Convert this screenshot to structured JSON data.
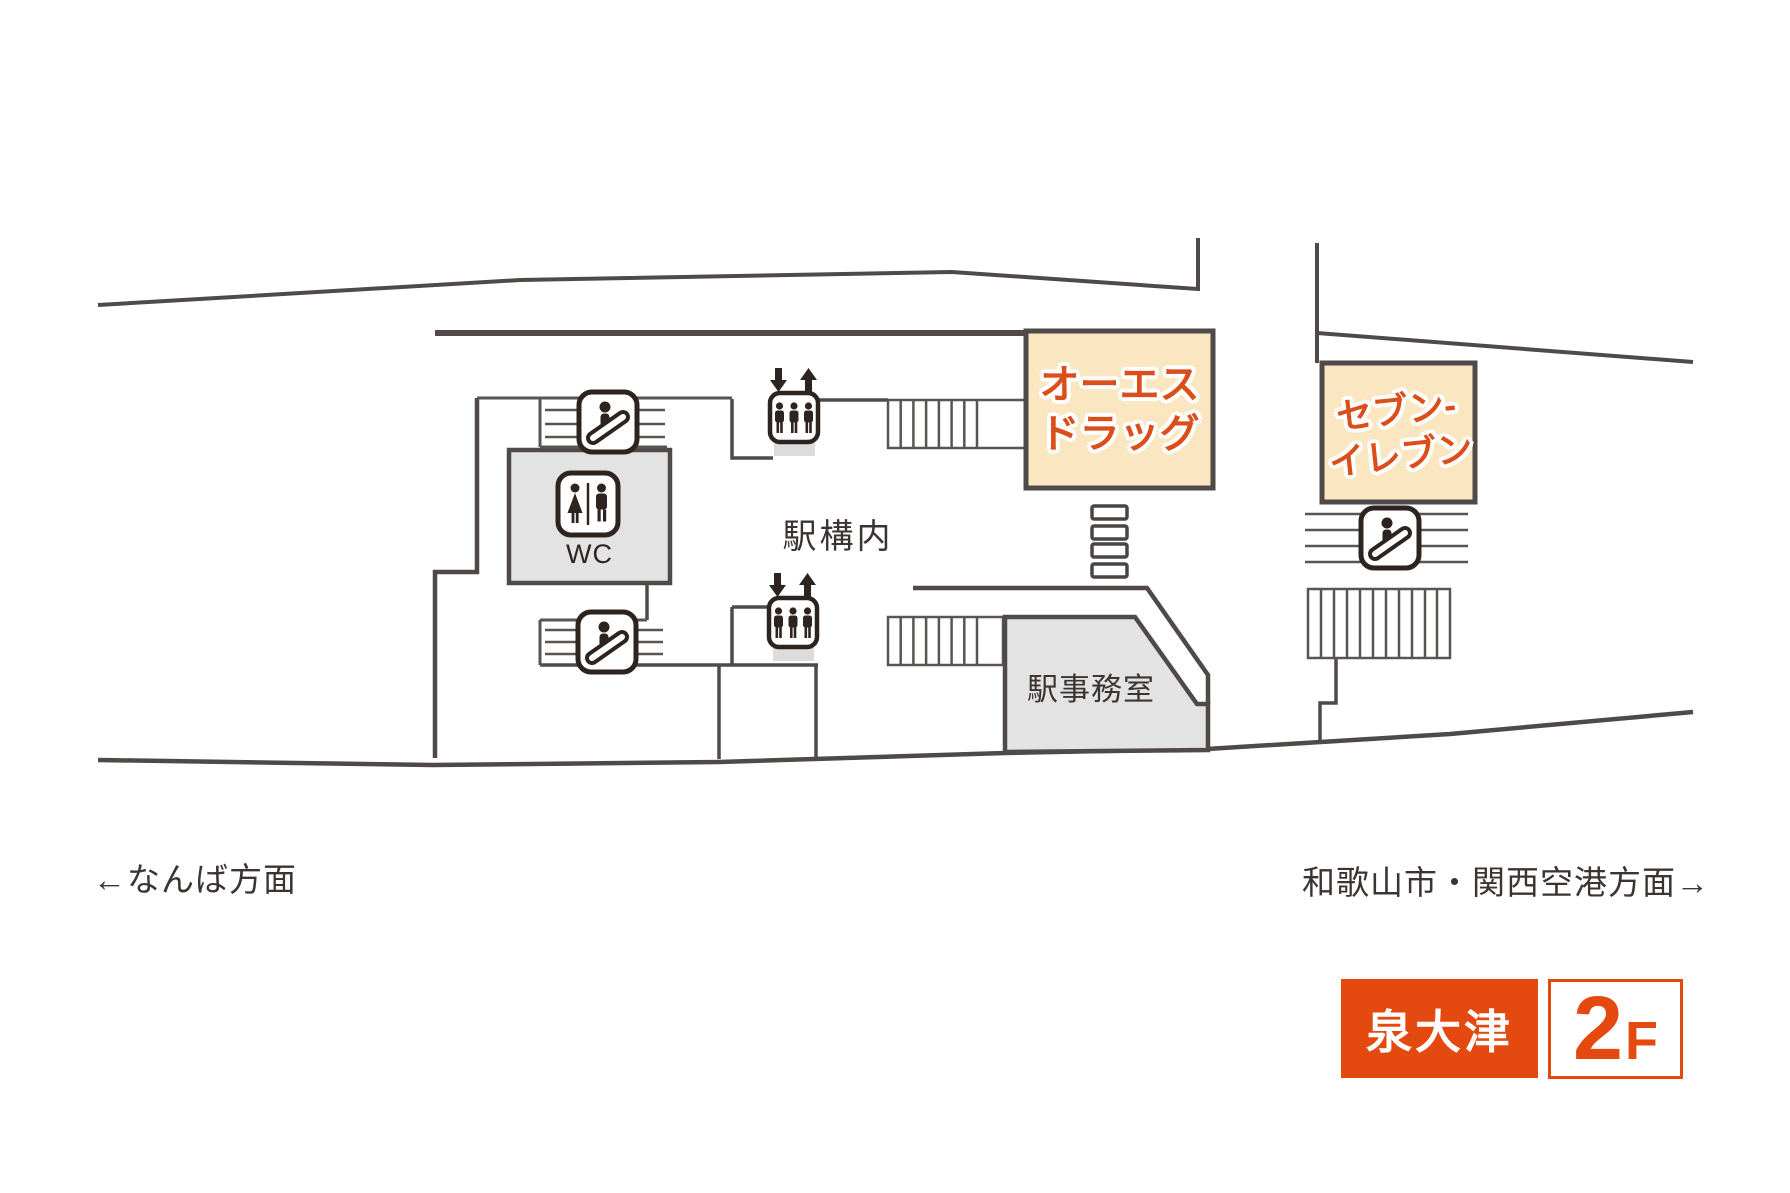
{
  "map": {
    "concourse_label": "駅構内",
    "office_label": "駅事務室",
    "restroom_label": "WC",
    "shops": [
      {
        "id": "os-drug",
        "line1": "オーエス",
        "line2": "ドラッグ"
      },
      {
        "id": "seven-eleven",
        "line1": "セブン-",
        "line2": "イレブン"
      }
    ],
    "directions": {
      "left": "←なんば方面",
      "right": "和歌山市・関西空港方面→"
    }
  },
  "badge": {
    "station_name": "泉大津",
    "floor_number": "2",
    "floor_suffix": "F"
  },
  "icons": {
    "escalator": "escalator-icon",
    "elevator": "elevator-icon",
    "elevator_arrows": "down-up-arrows",
    "restroom": "toilet-icon"
  },
  "colors": {
    "accent_orange": "#E4490F",
    "shop_fill": "#FAE7C1",
    "shop_text": "#DB4D19",
    "wall": "#4F4A48",
    "room_fill": "#E3E3E3",
    "icon_dark": "#2D2420",
    "text_dark": "#3B3432",
    "background": "#FFFFFF"
  }
}
